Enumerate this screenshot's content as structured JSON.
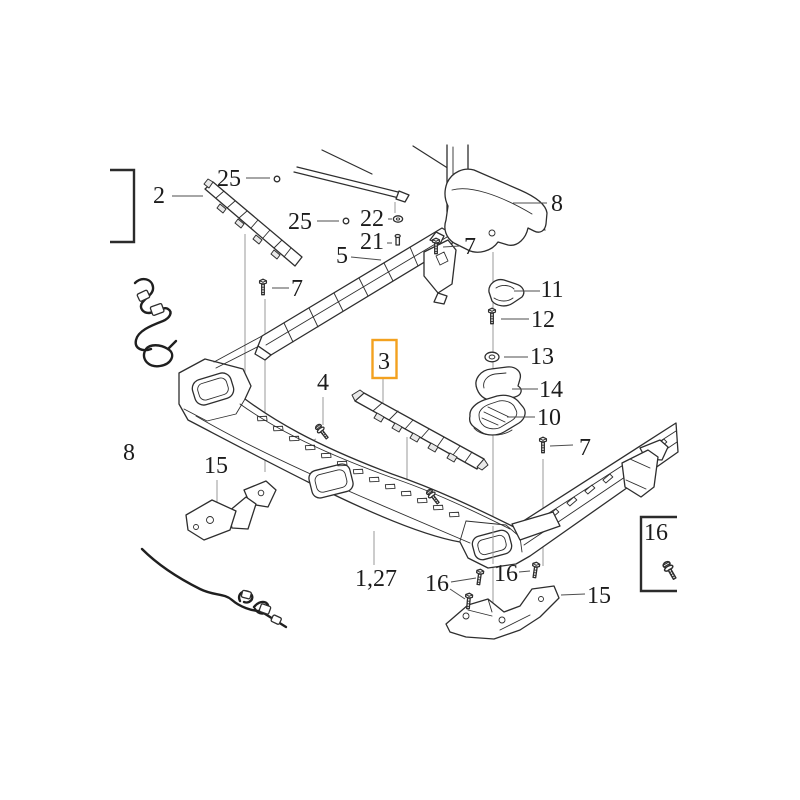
{
  "diagram": {
    "type": "exploded-parts-diagram",
    "background": "#ffffff",
    "ink_color": "#2e2e2e",
    "leader_color": "#9a9a9a",
    "label_color": "#1c1c1c",
    "highlight_color": "#f3a11f",
    "selected_label": "3",
    "labels": [
      {
        "id": "2",
        "text": "2",
        "x": 159,
        "y": 203
      },
      {
        "id": "25a",
        "text": "25",
        "x": 229,
        "y": 186
      },
      {
        "id": "25b",
        "text": "25",
        "x": 300,
        "y": 229
      },
      {
        "id": "22",
        "text": "22",
        "x": 372,
        "y": 226
      },
      {
        "id": "21",
        "text": "21",
        "x": 372,
        "y": 249
      },
      {
        "id": "5",
        "text": "5",
        "x": 342,
        "y": 263
      },
      {
        "id": "7a",
        "text": "7",
        "x": 470,
        "y": 254
      },
      {
        "id": "8a",
        "text": "8",
        "x": 557,
        "y": 211
      },
      {
        "id": "7c",
        "text": "7",
        "x": 297,
        "y": 296
      },
      {
        "id": "11",
        "text": "11",
        "x": 552,
        "y": 297
      },
      {
        "id": "12",
        "text": "12",
        "x": 543,
        "y": 327
      },
      {
        "id": "13",
        "text": "13",
        "x": 542,
        "y": 364
      },
      {
        "id": "14",
        "text": "14",
        "x": 551,
        "y": 397
      },
      {
        "id": "10",
        "text": "10",
        "x": 549,
        "y": 425
      },
      {
        "id": "3",
        "text": "3",
        "x": 384,
        "y": 369,
        "highlighted": true
      },
      {
        "id": "4",
        "text": "4",
        "x": 323,
        "y": 390
      },
      {
        "id": "8b",
        "text": "8",
        "x": 129,
        "y": 460
      },
      {
        "id": "15a",
        "text": "15",
        "x": 216,
        "y": 473
      },
      {
        "id": "7b",
        "text": "7",
        "x": 585,
        "y": 455
      },
      {
        "id": "1-27",
        "text": "1,27",
        "x": 376,
        "y": 586
      },
      {
        "id": "16a",
        "text": "16",
        "x": 437,
        "y": 591
      },
      {
        "id": "16b",
        "text": "16",
        "x": 506,
        "y": 581
      },
      {
        "id": "15b",
        "text": "15",
        "x": 599,
        "y": 603
      },
      {
        "id": "16c",
        "text": "16",
        "x": 656,
        "y": 540
      }
    ]
  }
}
